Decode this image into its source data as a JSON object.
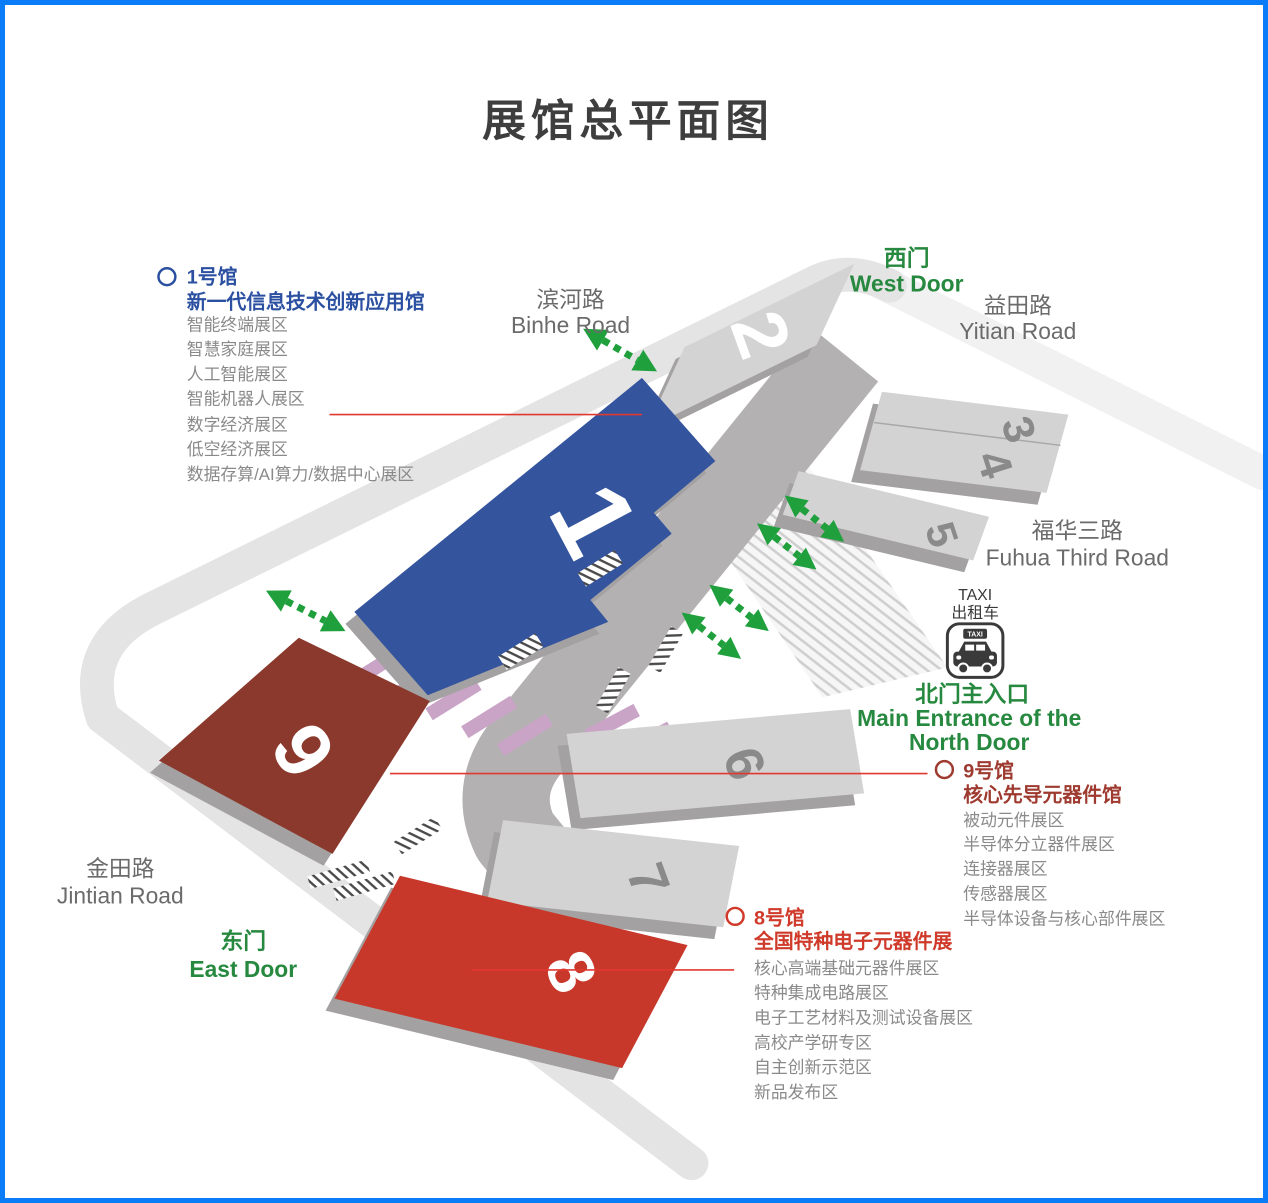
{
  "page": {
    "title": "展馆总平面图"
  },
  "halls": {
    "h1": {
      "number": "1"
    },
    "h2": {
      "number": "2"
    },
    "h3": {
      "number": "3"
    },
    "h4": {
      "number": "4"
    },
    "h5": {
      "number": "5"
    },
    "h6": {
      "number": "6"
    },
    "h7": {
      "number": "7"
    },
    "h8": {
      "number": "8"
    },
    "h9": {
      "number": "9"
    }
  },
  "roads": {
    "binhe": {
      "zh": "滨河路",
      "en": "Binhe Road"
    },
    "yitian": {
      "zh": "益田路",
      "en": "Yitian Road"
    },
    "fuhua": {
      "zh": "福华三路",
      "en": "Fuhua Third Road"
    },
    "jintian": {
      "zh": "金田路",
      "en": "Jintian Road"
    }
  },
  "doors": {
    "west": {
      "zh": "西门",
      "en": "West Door"
    },
    "east": {
      "zh": "东门",
      "en": "East Door"
    },
    "north": {
      "zh": "北门主入口",
      "en_line1": "Main Entrance of the",
      "en_line2": "North Door"
    }
  },
  "taxi": {
    "en": "TAXI",
    "zh": "出租车",
    "sign": "TAXI"
  },
  "legend_hall1": {
    "name": "1号馆",
    "title": "新一代信息技术创新应用馆",
    "items": [
      "智能终端展区",
      "智慧家庭展区",
      "人工智能展区",
      "智能机器人展区",
      "数字经济展区",
      "低空经济展区",
      "数据存算/AI算力/数据中心展区"
    ]
  },
  "legend_hall9": {
    "name": "9号馆",
    "title": "核心先导元器件馆",
    "items": [
      "被动元件展区",
      "半导体分立器件展区",
      "连接器展区",
      "传感器展区",
      "半导体设备与核心部件展区"
    ]
  },
  "legend_hall8": {
    "name": "8号馆",
    "title": "全国特种电子元器件展",
    "items": [
      "核心高端基础元器件展区",
      "特种集成电路展区",
      "电子工艺材料及测试设备展区",
      "高校产学研专区",
      "自主创新示范区",
      "新品发布区"
    ]
  },
  "colors": {
    "border": "#0b7cf7",
    "hall1_blue": "#34549e",
    "hall8_red": "#c8382a",
    "hall9_dark_red": "#8a392c",
    "hall_gray": "#d4d3d3",
    "ring_road": "#e4e4e4",
    "ring_road_light": "#f1f1f1",
    "concourse": "#b3b1b1",
    "crosswalk_pink": "#c9a4c6",
    "green": "#27893f",
    "arrow_green": "#1fa03c",
    "legend_blue": "#2b50a1",
    "legend_red9": "#9e3a2f",
    "legend_red8": "#cf3a2a",
    "callout_red": "#e0392f",
    "title_gray": "#3e3e3e"
  }
}
